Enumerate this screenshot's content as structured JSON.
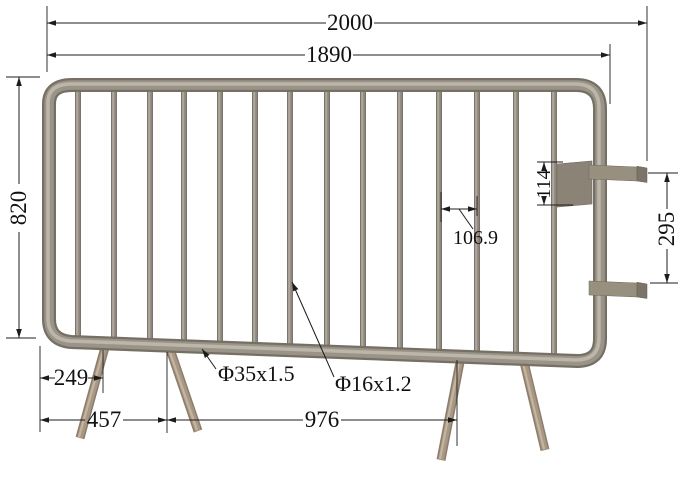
{
  "drawing": {
    "background_color": "#ffffff",
    "annotation_color": "#1c1c1c",
    "tube_color": "#9a9388",
    "tube_highlight_color": "#bcb5a9",
    "tube_shadow_color": "#756f64",
    "leg_color": "#a79784",
    "hook_plate_color": "#8a8376",
    "hook_color": "#97907f"
  },
  "dims": {
    "overall_width": "2000",
    "panel_width": "1890",
    "height": "820",
    "hook_plate_height": "114",
    "hook_spacing": "295",
    "bar_spacing": "106.9",
    "frame_tube_spec": "Φ35x1.5",
    "infill_tube_spec": "Φ16x1.2",
    "leg_offset": "249",
    "leg_inner_span": "457",
    "leg_span": "976"
  }
}
